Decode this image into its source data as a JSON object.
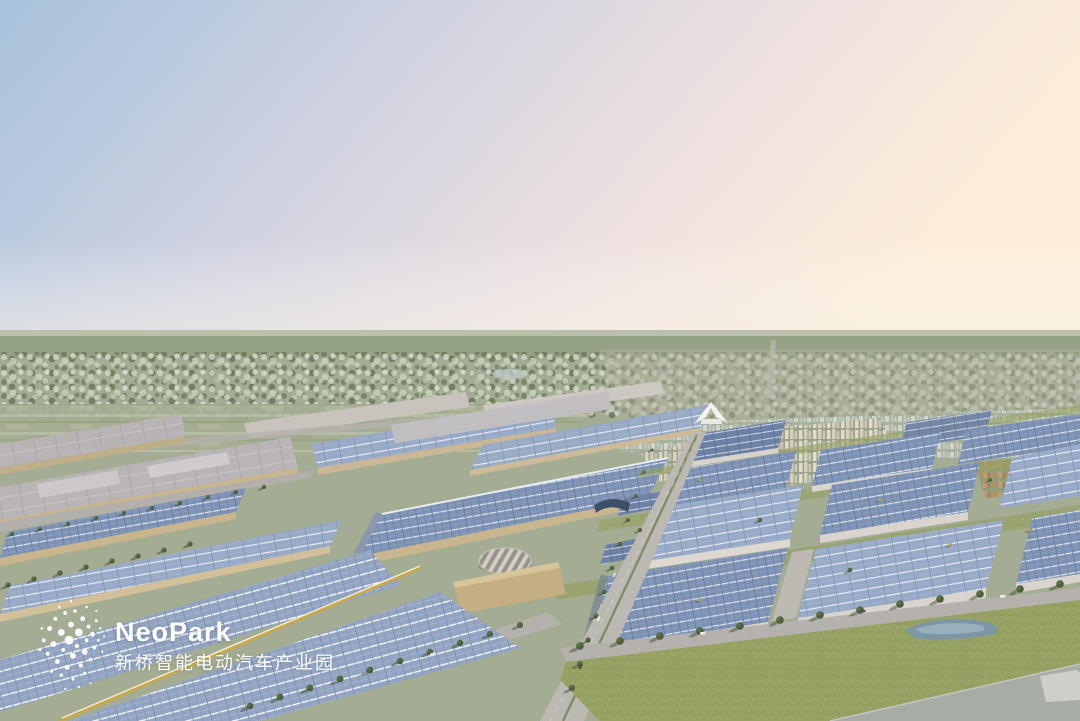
{
  "scene": {
    "type": "aerial-architectural-rendering",
    "description": "Bird's-eye dusk rendering of the NeoPark intelligent electric-vehicle industrial park: rows of factory halls and warehouses with blue rooftop solar panels, a central tree-lined boulevard, a round striped landmark building, a white tent-roofed pavilion, distant residential towers and farmland under a blue-to-peach gradient sky.",
    "palette": {
      "sky_left": "#a7c2dc",
      "sky_mid": "#ddd9e2",
      "sky_right": "#fdeed9",
      "distant_field": "#a4ac93",
      "tree_green": "#4b5d3b",
      "solar_roof": "#7e93b5",
      "solar_roof_light": "#98aac7",
      "solar_roof_dark": "#6e82a6",
      "gray_roof": "#b9b4b6",
      "wall_tan": "#c9b68f",
      "road": "#bcb9b3",
      "grass": "#96a164",
      "concrete": "#a7aca5",
      "water": "#7d96a6"
    }
  },
  "watermark": {
    "brand": "NeoPark",
    "subtitle": "新桥智能电动汽车产业园",
    "logo_icon": "dot-cluster-logo",
    "color": "#ffffff"
  }
}
